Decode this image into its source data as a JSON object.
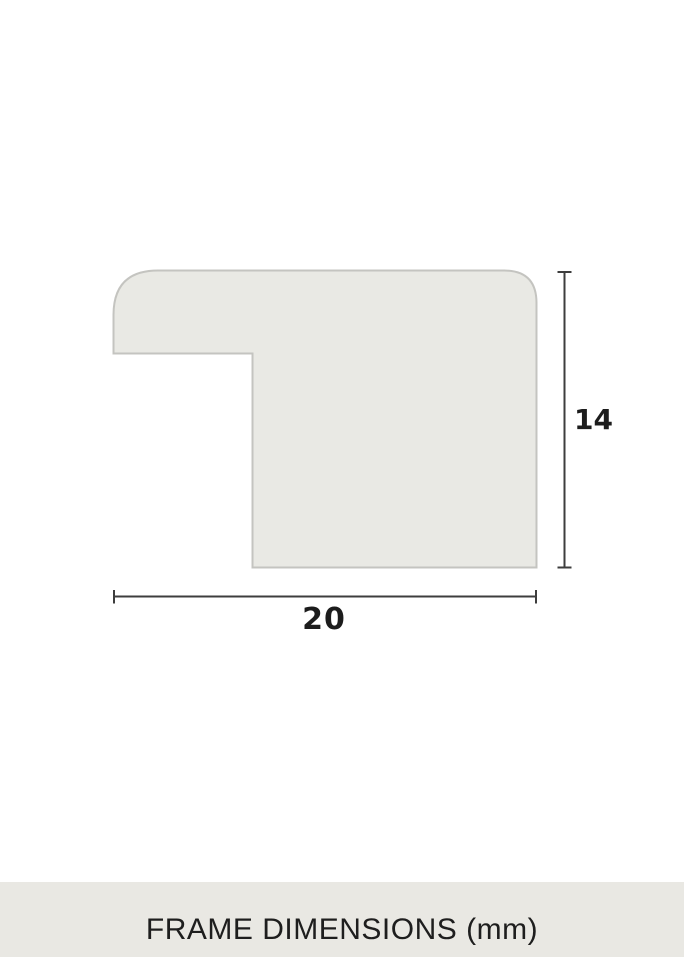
{
  "diagram": {
    "type": "frame-moulding-profile-cross-section",
    "width_label": "20",
    "height_label": "14",
    "units": "mm"
  },
  "footer": {
    "caption": "FRAME DIMENSIONS (mm)"
  },
  "colors": {
    "background": "#ffffff",
    "profile_fill": "#e9e9e4",
    "profile_stroke": "#c4c4c0",
    "dimension_line": "#3d3d3d",
    "label_text": "#1c1c1c",
    "footer_background": "#e9e8e3",
    "footer_text": "#1e1e1e"
  }
}
